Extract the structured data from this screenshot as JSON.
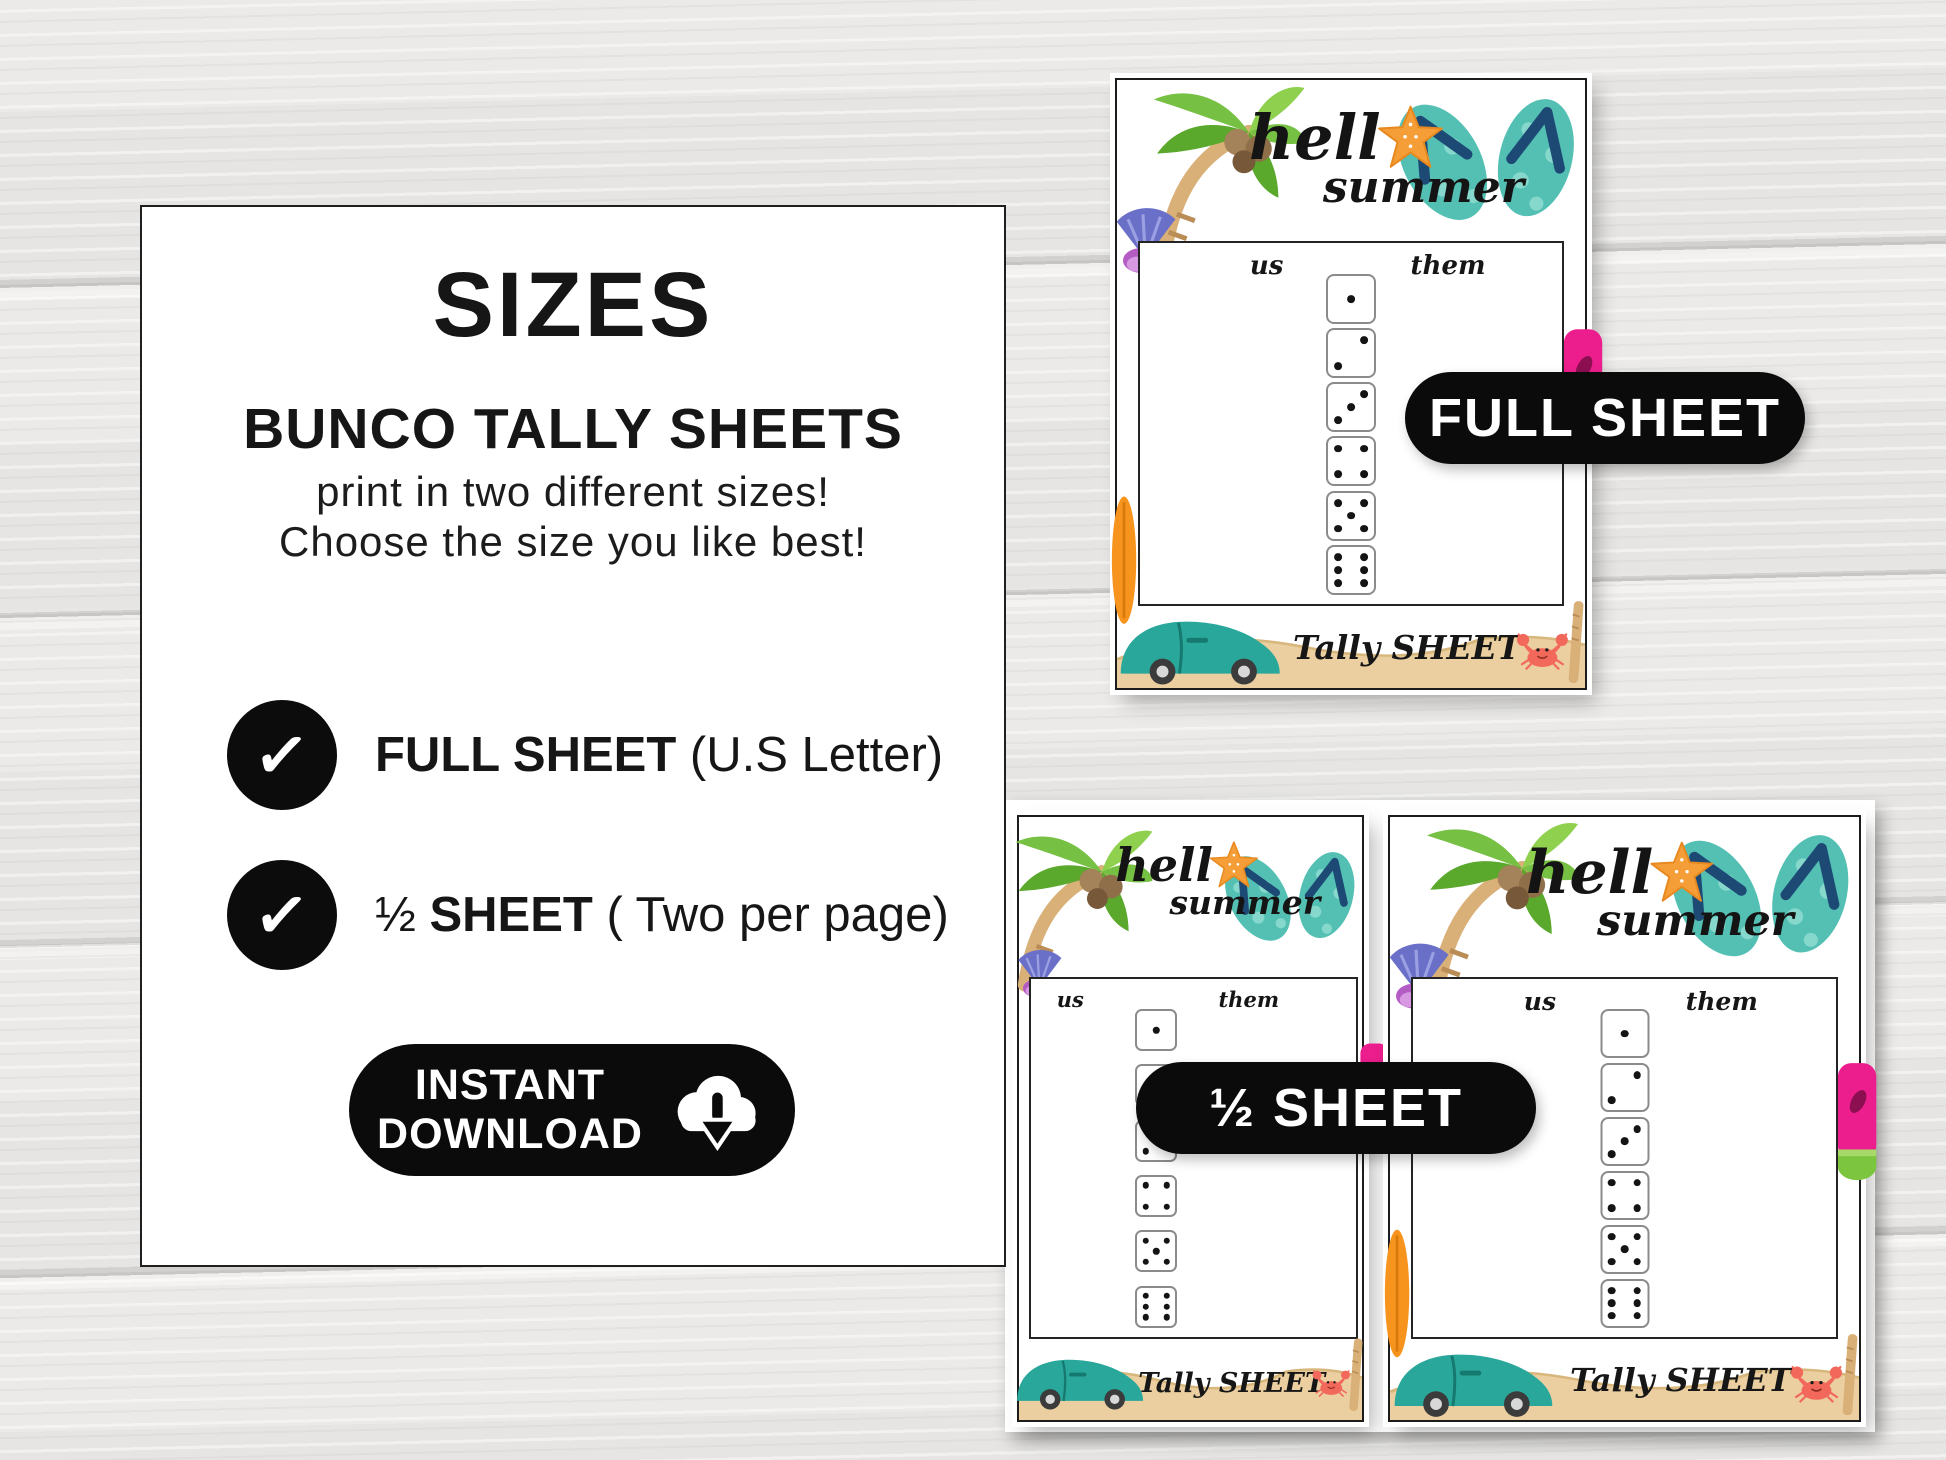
{
  "info_card": {
    "title": "SIZES",
    "heading": "BUNCO TALLY SHEETS",
    "line1": "print in two different sizes!",
    "line2": "Choose the size you like best!",
    "options": [
      {
        "check": "✓",
        "prefix": "",
        "bold": "FULL SHEET",
        "regular": " (U.S Letter)"
      },
      {
        "check": "✓",
        "prefix": "½ ",
        "bold": "SHEET",
        "regular": " ( Two per page)"
      }
    ],
    "download": {
      "line1": "INSTANT",
      "line2": "DOWNLOAD",
      "icon": "cloud-download-icon"
    }
  },
  "labels": {
    "full_sheet": "FULL SHEET",
    "half_sheet": "½ SHEET"
  },
  "sheet": {
    "hello_line1": "hell",
    "hello_line2": "summer",
    "star_icon": "starfish-icon",
    "us": "us",
    "them": "them",
    "tally": "Tally SHEET",
    "dice_values": [
      1,
      2,
      3,
      4,
      5,
      6
    ]
  },
  "colors": {
    "black": "#0b0b0b",
    "white": "#ffffff",
    "wood_base": "#ebeae8",
    "wood_seam": "#c7c6c4",
    "flipflop_teal": "#54c0b4",
    "flipflop_heart": "#86d7cc",
    "strap_navy": "#1d4a75",
    "starfish_orange": "#f59e38",
    "palm_green": "#76c043",
    "palm_green_dark": "#5aa82c",
    "trunk_tan": "#d9b078",
    "coconut_brown": "#8f6f49",
    "shell_purple": "#6a6fc7",
    "shell_magenta": "#c06ad0",
    "car_teal": "#2aa79b",
    "sand_beige": "#ebcfa0",
    "crab_coral": "#f2695c",
    "popsicle_pink": "#ec1e8d",
    "surfboard_orange": "#f7941d"
  }
}
